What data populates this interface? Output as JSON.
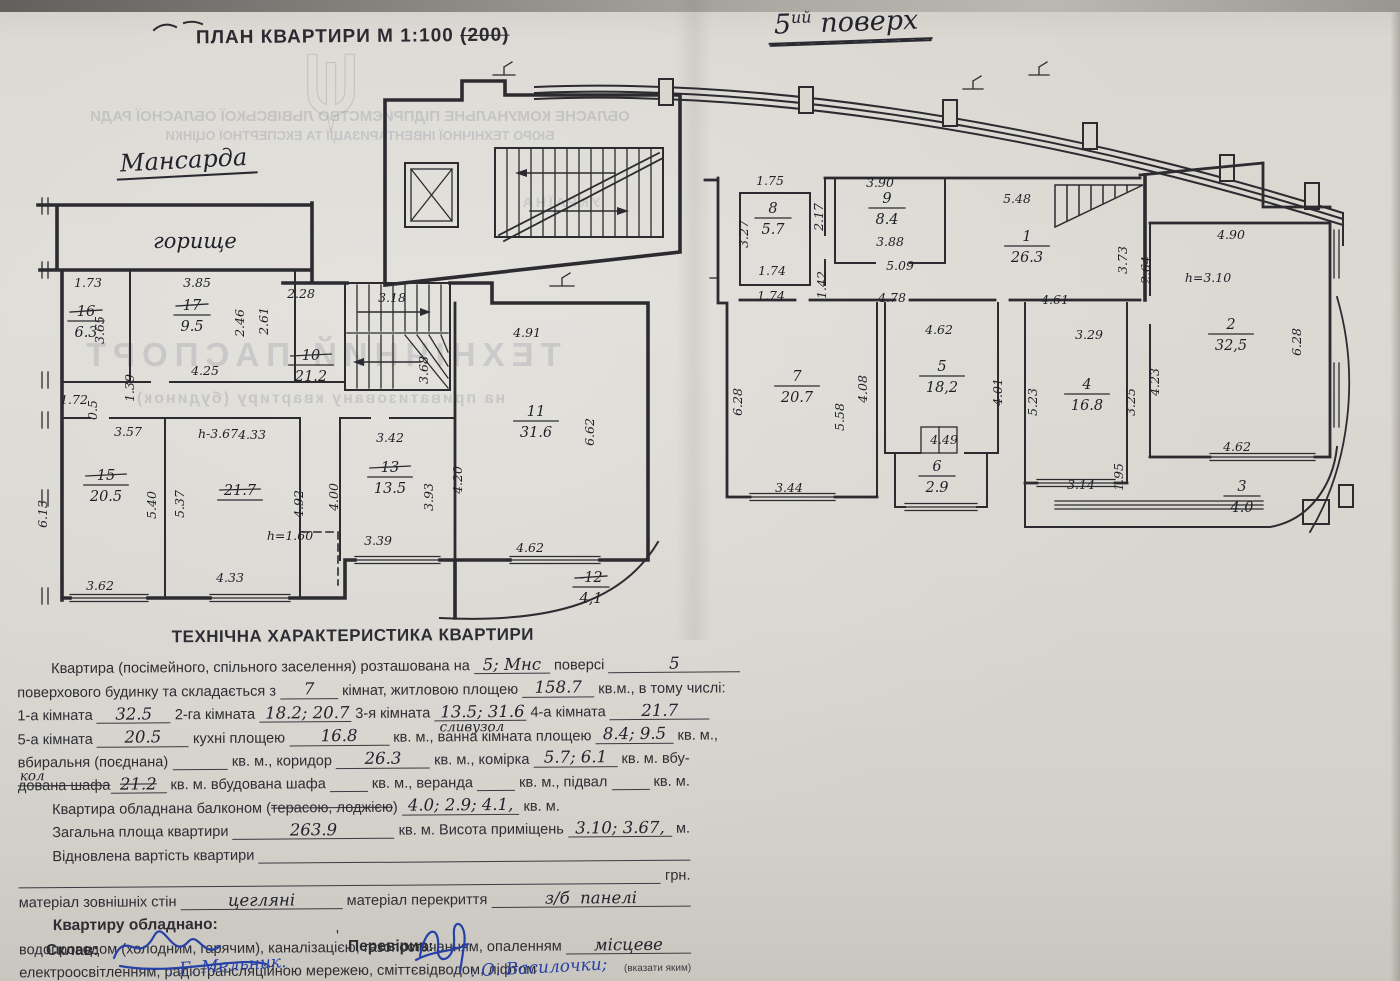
{
  "page": {
    "title": "ПЛАН КВАРТИРИ М 1:100 ",
    "title_scale_struck": "(200)",
    "floor_note": {
      "num": "5",
      "sup": "ий",
      "word": " поверх"
    },
    "mansard_note": "Мансарда"
  },
  "bleedthrough": {
    "line1": "ОБЛАСНЕ КОМУНАЛЬНЕ ПІДПРИЄМСТВО ЛЬВІВСЬКОЇ ОБЛАСНОЇ РАДИ",
    "line2": "БЮРО ТЕХНІЧНОЇ ІНВЕНТАРИЗАЦІЇ ТА ЕКСПЕРТНОЇ ОЦІНКИ",
    "line3": "ТЕХНІЧНИЙ ПАСПОРТ",
    "line4": "на приватизовану квартиру (будинок)",
    "line5": "УКРАЇНА"
  },
  "mansard_plan": {
    "attic_label": "горище",
    "rooms": [
      {
        "n": "16",
        "a": "6.3",
        "x": 86,
        "y": 126,
        "strike": "n"
      },
      {
        "n": "17",
        "a": "9.5",
        "x": 192,
        "y": 120,
        "strike": "n"
      },
      {
        "n": "10",
        "a": "21.2",
        "x": 311,
        "y": 170,
        "strike": "n"
      },
      {
        "n": "15",
        "a": "20.5",
        "x": 106,
        "y": 290,
        "strike": "n"
      },
      {
        "n": "",
        "a": "21.7",
        "x": 240,
        "y": 305,
        "strike": "a"
      },
      {
        "n": "13",
        "a": "13.5",
        "x": 390,
        "y": 282,
        "strike": "n"
      },
      {
        "n": "11",
        "a": "31.6",
        "x": 536,
        "y": 226,
        "strike": ""
      },
      {
        "n": "-12",
        "a": "4,1",
        "x": 591,
        "y": 392,
        "strike": "n"
      }
    ],
    "dims": [
      {
        "t": "1.73",
        "x": 88,
        "y": 97
      },
      {
        "t": "3.85",
        "x": 197,
        "y": 97
      },
      {
        "t": "2.28",
        "x": 301,
        "y": 108
      },
      {
        "t": "3.65",
        "x": 104,
        "y": 140,
        "r": 1
      },
      {
        "t": "2.46",
        "x": 244,
        "y": 133,
        "r": 1
      },
      {
        "t": "2.61",
        "x": 268,
        "y": 131,
        "r": 1
      },
      {
        "t": "4.25",
        "x": 205,
        "y": 185
      },
      {
        "t": "1.39",
        "x": 134,
        "y": 198,
        "r": 1
      },
      {
        "t": "1.72",
        "x": 74,
        "y": 214
      },
      {
        "t": "0.5",
        "x": 97,
        "y": 220,
        "r": 1
      },
      {
        "t": "3.57",
        "x": 128,
        "y": 246
      },
      {
        "t": "h-3.67",
        "x": 218,
        "y": 248
      },
      {
        "t": "4.33",
        "x": 252,
        "y": 249
      },
      {
        "t": "5.40",
        "x": 156,
        "y": 315,
        "r": 1
      },
      {
        "t": "5.37",
        "x": 184,
        "y": 314,
        "r": 1
      },
      {
        "t": "6.13",
        "x": 47,
        "y": 324,
        "r": 1
      },
      {
        "t": "4.92",
        "x": 303,
        "y": 314,
        "r": 1
      },
      {
        "t": "4.00",
        "x": 338,
        "y": 307,
        "r": 1
      },
      {
        "t": "3.42",
        "x": 390,
        "y": 252
      },
      {
        "t": "3.93",
        "x": 433,
        "y": 307,
        "r": 1
      },
      {
        "t": "4.20",
        "x": 462,
        "y": 290,
        "r": 1
      },
      {
        "t": "3.39",
        "x": 378,
        "y": 355
      },
      {
        "t": "h=1.60",
        "x": 290,
        "y": 350
      },
      {
        "t": "4.33",
        "x": 230,
        "y": 392
      },
      {
        "t": "3.62",
        "x": 100,
        "y": 400
      },
      {
        "t": "4.91",
        "x": 527,
        "y": 147
      },
      {
        "t": "6.62",
        "x": 594,
        "y": 242,
        "r": 1
      },
      {
        "t": "4.62",
        "x": 530,
        "y": 362
      },
      {
        "t": "3.18",
        "x": 392,
        "y": 112
      },
      {
        "t": "3.68",
        "x": 428,
        "y": 180,
        "r": 1
      }
    ]
  },
  "floor_plan": {
    "rooms": [
      {
        "n": "8",
        "a": "5.7",
        "x": 408,
        "y": 168,
        "strike": ""
      },
      {
        "n": "9",
        "a": "8.4",
        "x": 522,
        "y": 158,
        "strike": ""
      },
      {
        "n": "1",
        "a": "26.3",
        "x": 662,
        "y": 196,
        "strike": ""
      },
      {
        "n": "2",
        "a": "32,5",
        "x": 866,
        "y": 284,
        "strike": ""
      },
      {
        "n": "7",
        "a": "20.7",
        "x": 432,
        "y": 336,
        "strike": ""
      },
      {
        "n": "5",
        "a": "18,2",
        "x": 577,
        "y": 326,
        "strike": ""
      },
      {
        "n": "4",
        "a": "16.8",
        "x": 722,
        "y": 344,
        "strike": ""
      },
      {
        "n": "6",
        "a": "2.9",
        "x": 572,
        "y": 426,
        "strike": ""
      },
      {
        "n": "3",
        "a": "4.0",
        "x": 877,
        "y": 446,
        "strike": ""
      }
    ],
    "dims": [
      {
        "t": "1.75",
        "x": 405,
        "y": 140
      },
      {
        "t": "3.27",
        "x": 383,
        "y": 189,
        "r": 1
      },
      {
        "t": "2.17",
        "x": 458,
        "y": 172,
        "r": 1
      },
      {
        "t": "3.90",
        "x": 515,
        "y": 142
      },
      {
        "t": "3.88",
        "x": 525,
        "y": 201
      },
      {
        "t": "5.48",
        "x": 652,
        "y": 158
      },
      {
        "t": "5.09",
        "x": 535,
        "y": 225
      },
      {
        "t": "1.74",
        "x": 407,
        "y": 230
      },
      {
        "t": "1.74",
        "x": 406,
        "y": 255
      },
      {
        "t": "1.42",
        "x": 461,
        "y": 240,
        "r": 1
      },
      {
        "t": "4.78",
        "x": 527,
        "y": 257
      },
      {
        "t": "4.61",
        "x": 690,
        "y": 259
      },
      {
        "t": "3.73",
        "x": 762,
        "y": 215,
        "r": 1
      },
      {
        "t": "2.64",
        "x": 785,
        "y": 225,
        "r": 1
      },
      {
        "t": "4.90",
        "x": 866,
        "y": 194
      },
      {
        "t": "h=3.10",
        "x": 843,
        "y": 237
      },
      {
        "t": "6.28",
        "x": 936,
        "y": 297,
        "r": 1
      },
      {
        "t": "4.62",
        "x": 872,
        "y": 406
      },
      {
        "t": "3.29",
        "x": 724,
        "y": 294
      },
      {
        "t": "5.23",
        "x": 672,
        "y": 357,
        "r": 1
      },
      {
        "t": "3.25",
        "x": 770,
        "y": 357,
        "r": 1
      },
      {
        "t": "4.23",
        "x": 794,
        "y": 337,
        "r": 1
      },
      {
        "t": "3.14",
        "x": 716,
        "y": 444
      },
      {
        "t": "1.95",
        "x": 758,
        "y": 432,
        "r": 1
      },
      {
        "t": "6.28",
        "x": 377,
        "y": 357,
        "r": 1
      },
      {
        "t": "5.58",
        "x": 479,
        "y": 372,
        "r": 1
      },
      {
        "t": "4.08",
        "x": 502,
        "y": 344,
        "r": 1
      },
      {
        "t": "4.62",
        "x": 574,
        "y": 289
      },
      {
        "t": "4.01",
        "x": 637,
        "y": 347,
        "r": 1
      },
      {
        "t": "4.49",
        "x": 579,
        "y": 399
      },
      {
        "t": "3.44",
        "x": 424,
        "y": 447
      }
    ]
  },
  "form": {
    "heading": "ТЕХНІЧНА ХАРАКТЕРИСТИКА КВАРТИРИ",
    "lines": [
      {
        "i": 1,
        "s": [
          [
            "p",
            "Квартира (посімейного, спільного заселення) розташована на "
          ],
          [
            "h",
            "5; Мнс",
            64
          ],
          [
            "p",
            " поверсі "
          ],
          [
            "h",
            "5",
            120
          ]
        ]
      },
      {
        "s": [
          [
            "p",
            "поверхового будинку та складається з "
          ],
          [
            "h",
            "7",
            46
          ],
          [
            "p",
            " кімнат, житловою площею "
          ],
          [
            "h",
            "158.7",
            60
          ],
          [
            "p",
            " кв.м., в тому числі:"
          ]
        ]
      },
      {
        "s": [
          [
            "p",
            "1-а кімната "
          ],
          [
            "h",
            "32.5",
            62
          ],
          [
            "p",
            " 2-га кімната "
          ],
          [
            "h",
            "18.2; 20.7",
            80
          ],
          [
            "p",
            " 3-я кімната "
          ],
          [
            "h",
            "13.5; 31.6",
            80
          ],
          [
            "p",
            " 4-а кімната "
          ],
          [
            "h",
            "21.7",
            88
          ]
        ]
      },
      {
        "s": [
          [
            "p",
            "5-а кімната "
          ],
          [
            "h",
            "20.5",
            80
          ],
          [
            "p",
            " кухні площею "
          ],
          [
            "h",
            "16.8",
            88
          ],
          [
            "p",
            " кв. м., "
          ],
          [
            "n",
            "сливузол"
          ],
          [
            "p",
            "ванна кімната площею "
          ],
          [
            "h",
            "8.4; 9.5",
            66
          ],
          [
            "p",
            " кв. м.,"
          ]
        ]
      },
      {
        "s": [
          [
            "p",
            "вбиральня (поєднана) "
          ],
          [
            "u",
            "",
            110
          ],
          [
            "p",
            " кв. м., коридор "
          ],
          [
            "h",
            "26.3",
            82
          ],
          [
            "p",
            " кв. м., комірка "
          ],
          [
            "h",
            "5.7; 6.1",
            72
          ],
          [
            "p",
            " кв. м. вбу-"
          ]
        ]
      },
      {
        "s": [
          [
            "n",
            "кол"
          ],
          [
            "ps",
            "дована шафа"
          ],
          [
            "hs",
            "21.2",
            44
          ],
          [
            "p",
            " кв. м. вбудована шафа "
          ],
          [
            "u",
            "",
            48
          ],
          [
            "p",
            " кв. м., веранда "
          ],
          [
            "u",
            "",
            48
          ],
          [
            "p",
            " кв. м., підвал "
          ],
          [
            "u",
            "",
            48
          ],
          [
            "p",
            " кв. м."
          ]
        ]
      },
      {
        "i": 1,
        "s": [
          [
            "p",
            "Квартира обладнана балконом ("
          ],
          [
            "ps",
            "терасою, лоджією"
          ],
          [
            "p",
            ") "
          ],
          [
            "h",
            "4.0; 2.9; 4.1,",
            96
          ],
          [
            "p",
            " кв. м."
          ]
        ]
      },
      {
        "i": 1,
        "s": [
          [
            "p",
            "Загальна площа квартири "
          ],
          [
            "h",
            "263.9",
            150
          ],
          [
            "p",
            " кв. м. Висота приміщень "
          ],
          [
            "h",
            "3.10; 3.67,",
            92
          ],
          [
            "p",
            " м."
          ]
        ]
      },
      {
        "i": 1,
        "s": [
          [
            "p",
            "Відновлена вартість квартири "
          ],
          [
            "uf",
            ""
          ]
        ]
      },
      {
        "s": [
          [
            "uf",
            ""
          ],
          [
            "p",
            " грн."
          ]
        ]
      },
      {
        "s": [
          [
            "p",
            "матеріал зовнішніх стін "
          ],
          [
            "h",
            "цегляні",
            150
          ],
          [
            "p",
            " матеріал перекриття "
          ],
          [
            "hf",
            "з/б  панелі"
          ]
        ]
      },
      {
        "b": 1,
        "i": 1,
        "s": [
          [
            "p",
            "Квартиру обладнано:"
          ]
        ]
      },
      {
        "s": [
          [
            "p",
            "водопроводом (холодним, гарячим), каналізацією, газопостачанням, опаленням "
          ],
          [
            "hf",
            "місцеве"
          ]
        ]
      },
      {
        "s": [
          [
            "p",
            "електроосвітленням, радіотрансляційною мережею, сміттєвідводом, ліфтом"
          ],
          [
            "sub",
            "(вказати яким)"
          ]
        ]
      }
    ]
  },
  "signatures": {
    "made_label": "Склав:",
    "made_name": ": Г. Мельник.",
    "checked_tick": "'",
    "checked_label": "Перевірив:",
    "checked_name": ": О. Василочки;"
  }
}
